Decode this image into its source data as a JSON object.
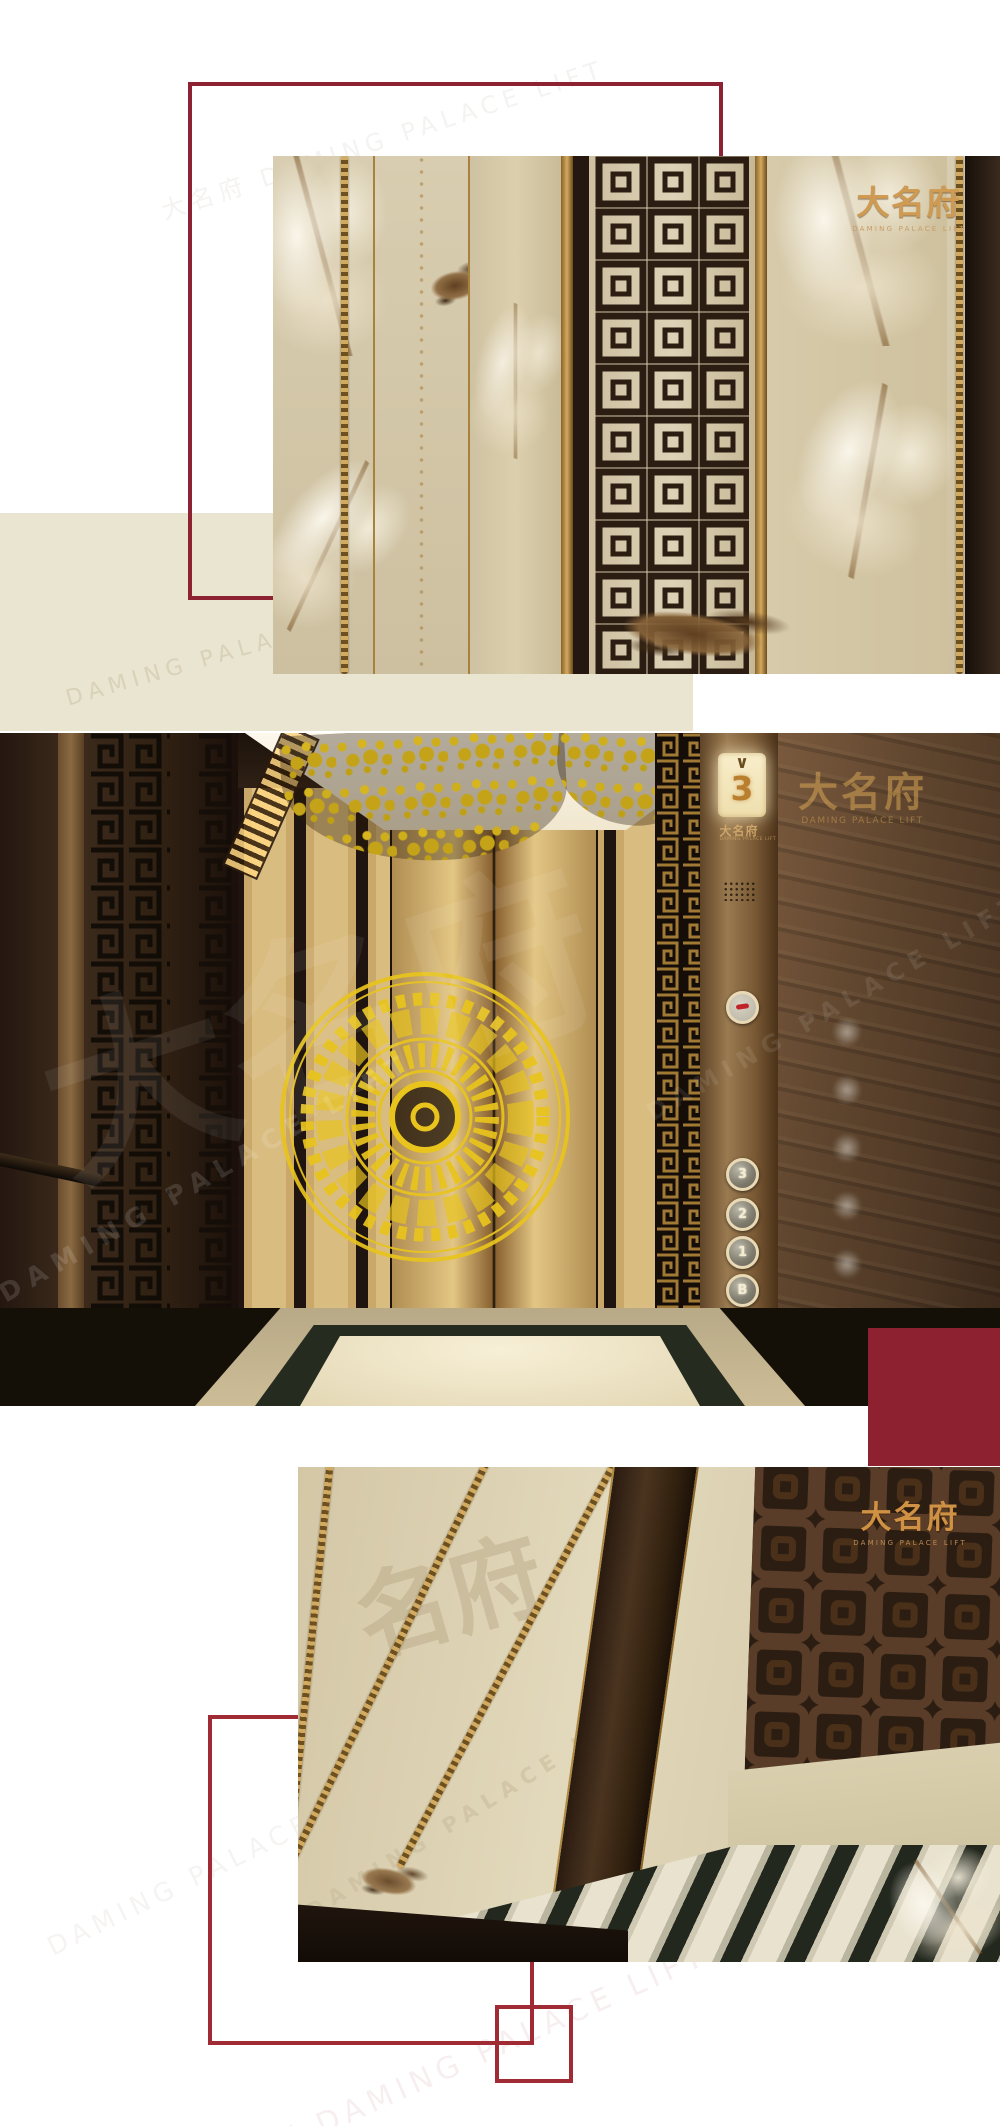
{
  "brand": {
    "cn": "大名府",
    "en": "DAMING PALACE LIFT"
  },
  "colors": {
    "accent_red": "#8e2130",
    "frame_red": "#a12b35",
    "beige": "#eae5d0",
    "gold": "#cf9b52",
    "medallion_gold": "#e8c41d"
  },
  "photo_top": {
    "logo_cn": "大名府",
    "logo_en": "DAMING PALACE LIFT"
  },
  "photo_middle": {
    "floor_display": {
      "arrow": "∨",
      "floor": "3"
    },
    "panel_logo_cn": "大名府",
    "panel_logo_en": "DAMING PALACE LIFT",
    "wall_logo_cn": "大名府",
    "wall_logo_en": "DAMING PALACE LIFT",
    "watermark_cn": "大名府",
    "watermark_en": "DAMING PALACE LIFT",
    "buttons": [
      {
        "id": "floor-3",
        "label": "3"
      },
      {
        "id": "floor-2",
        "label": "2"
      },
      {
        "id": "floor-1",
        "label": "1"
      },
      {
        "id": "floor-b",
        "label": "B"
      },
      {
        "id": "door-open",
        "label": "◁▷"
      },
      {
        "id": "door-close",
        "label": "▷◁"
      }
    ]
  },
  "photo_bottom": {
    "logo_cn": "大名府",
    "logo_en": "DAMING PALACE LIFT",
    "watermark_cn": "名府",
    "watermark_en": "DAMING PALACE LIFT"
  },
  "page_watermarks": {
    "combo": "大名府 DAMING PALACE LIFT",
    "en": "DAMING PALACE LIFT"
  }
}
